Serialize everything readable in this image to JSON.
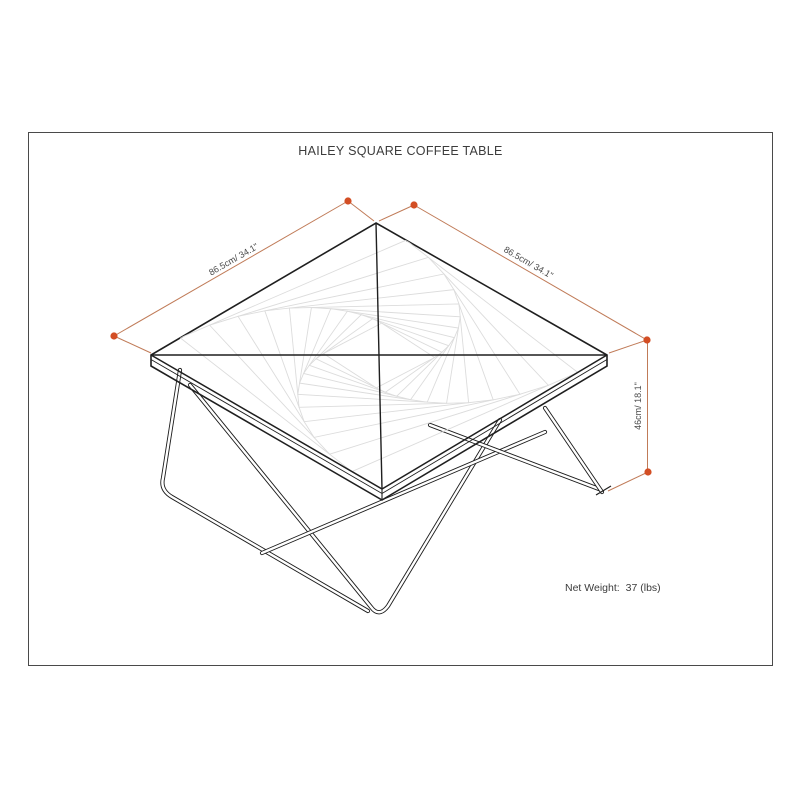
{
  "header": {
    "title": "HAILEY SQUARE COFFEE TABLE"
  },
  "dimensions": {
    "left_edge_label": "86.5cm/ 34.1\"",
    "right_edge_label": "86.5cm/ 34.1\"",
    "height_label": "46cm/ 18.1\""
  },
  "footer": {
    "net_weight_label": "Net Weight:",
    "net_weight_value": "37 (lbs)"
  },
  "colors": {
    "dimension_line": "#c07b58",
    "dimension_dot": "#d34e24",
    "drawing_line": "#1f1f1f",
    "grain_line": "#dcdcdc",
    "text": "#3c3c3c",
    "border": "#4a4a4a"
  }
}
